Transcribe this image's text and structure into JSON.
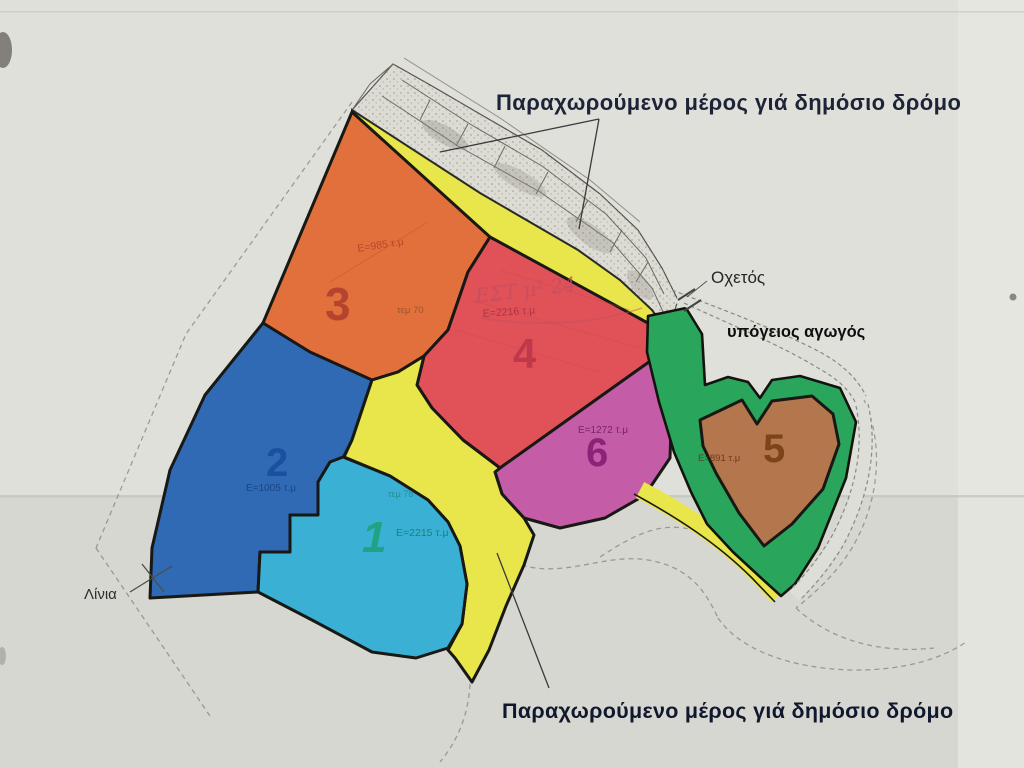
{
  "annotations": {
    "top_note": "Παραχωρούμενο μέρος γιά δημόσιο δρόμο",
    "bottom_note": "Παραχωρούμενο μέρος γιά δημόσιο δρόμο",
    "culvert_label": "Οχετός",
    "pipe_label": "υπόγειος αγωγός",
    "place_label": "Λίνια"
  },
  "parcels": [
    {
      "id": "1",
      "area": "Ε=2215 τ.μ",
      "ref": "τεμ 78",
      "fill": "#3ab0d4",
      "num_color": "#1fa383",
      "area_color": "#157a68"
    },
    {
      "id": "2",
      "area": "Ε=1005 τ.μ",
      "ref": "",
      "fill": "#3069b4",
      "num_color": "#1c4fa0",
      "area_color": "#16407e"
    },
    {
      "id": "3",
      "area": "Ε=985 τ.μ",
      "ref": "τεμ 70",
      "fill": "#e2703c",
      "num_color": "#b5442f",
      "area_color": "#b03a28"
    },
    {
      "id": "4",
      "area": "Ε=2216 τ.μ",
      "ref": "",
      "fill": "#e05158",
      "num_color": "#c0394a",
      "area_color": "#a93040",
      "handwriting": "ΕΣΤ μ² 24"
    },
    {
      "id": "5",
      "area": "Ε=891 τ.μ",
      "ref": "",
      "fill": "#b4764d",
      "num_color": "#7c4418",
      "area_color": "#5f3412"
    },
    {
      "id": "6",
      "area": "Ε=1272 τ.μ",
      "ref": "",
      "fill": "#c45ca8",
      "num_color": "#8c2376",
      "area_color": "#701e60"
    }
  ],
  "map_features": {
    "ceded_road_color": "#e9e64c",
    "buffer_color": "#2aa65c",
    "paper_color": "#dedeD9"
  }
}
